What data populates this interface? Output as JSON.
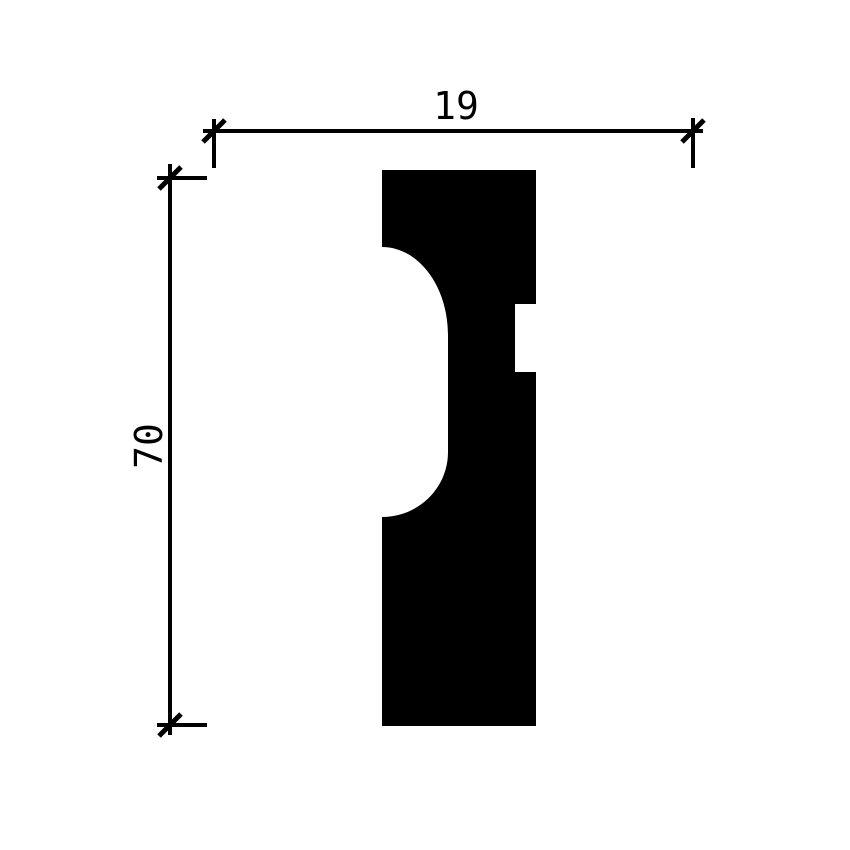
{
  "diagram": {
    "ink_color": "#000000",
    "background_color": "#ffffff",
    "dimensions": {
      "width": {
        "label": "19"
      },
      "height": {
        "label": "70"
      }
    }
  }
}
